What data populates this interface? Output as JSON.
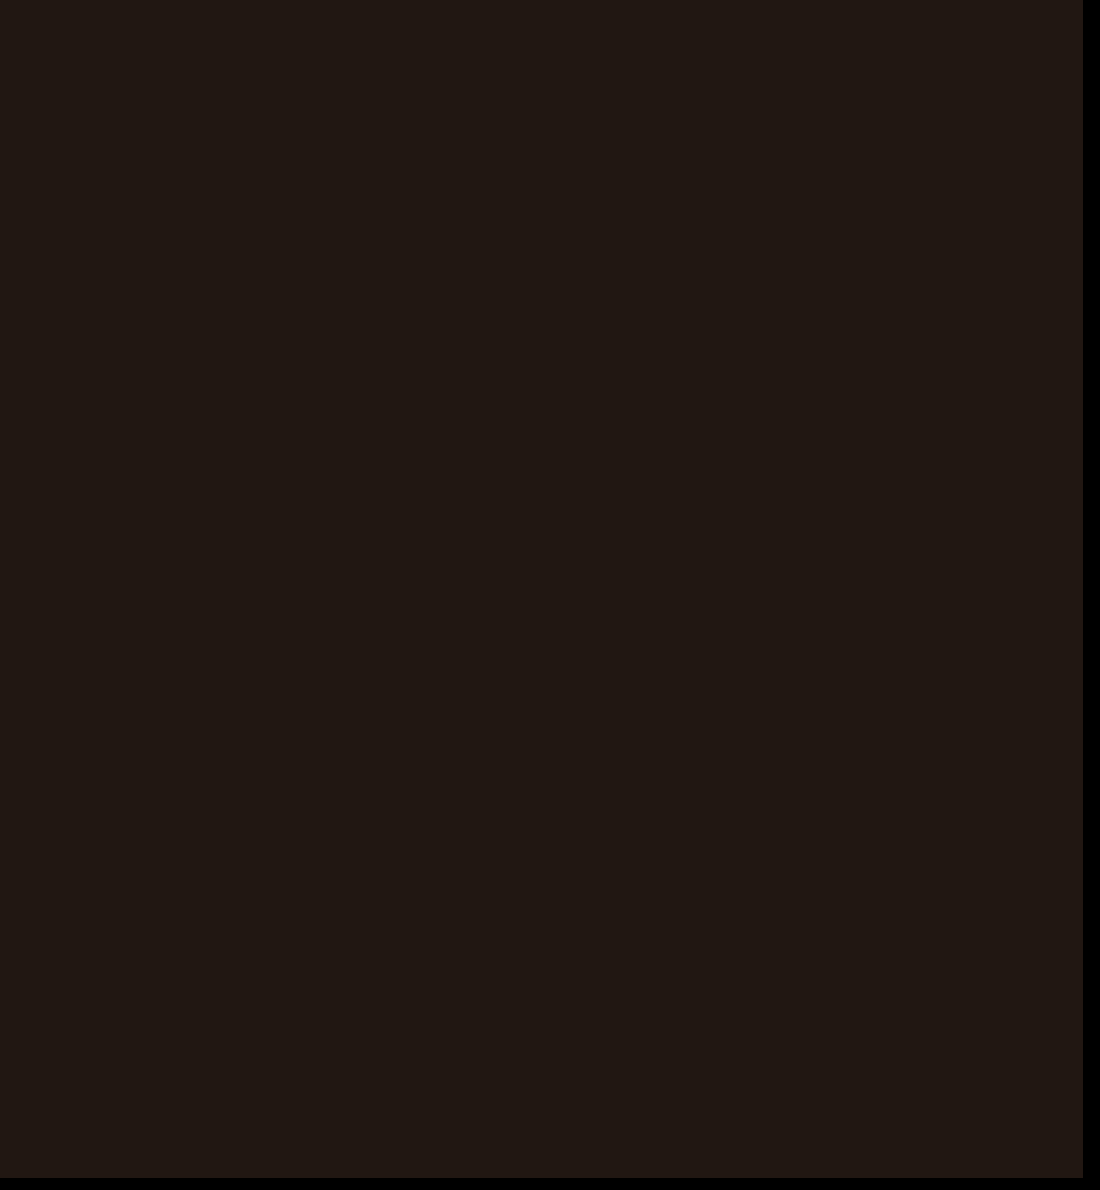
{
  "screen": {
    "background_color": "#211712",
    "bezel_color": "#000000"
  }
}
